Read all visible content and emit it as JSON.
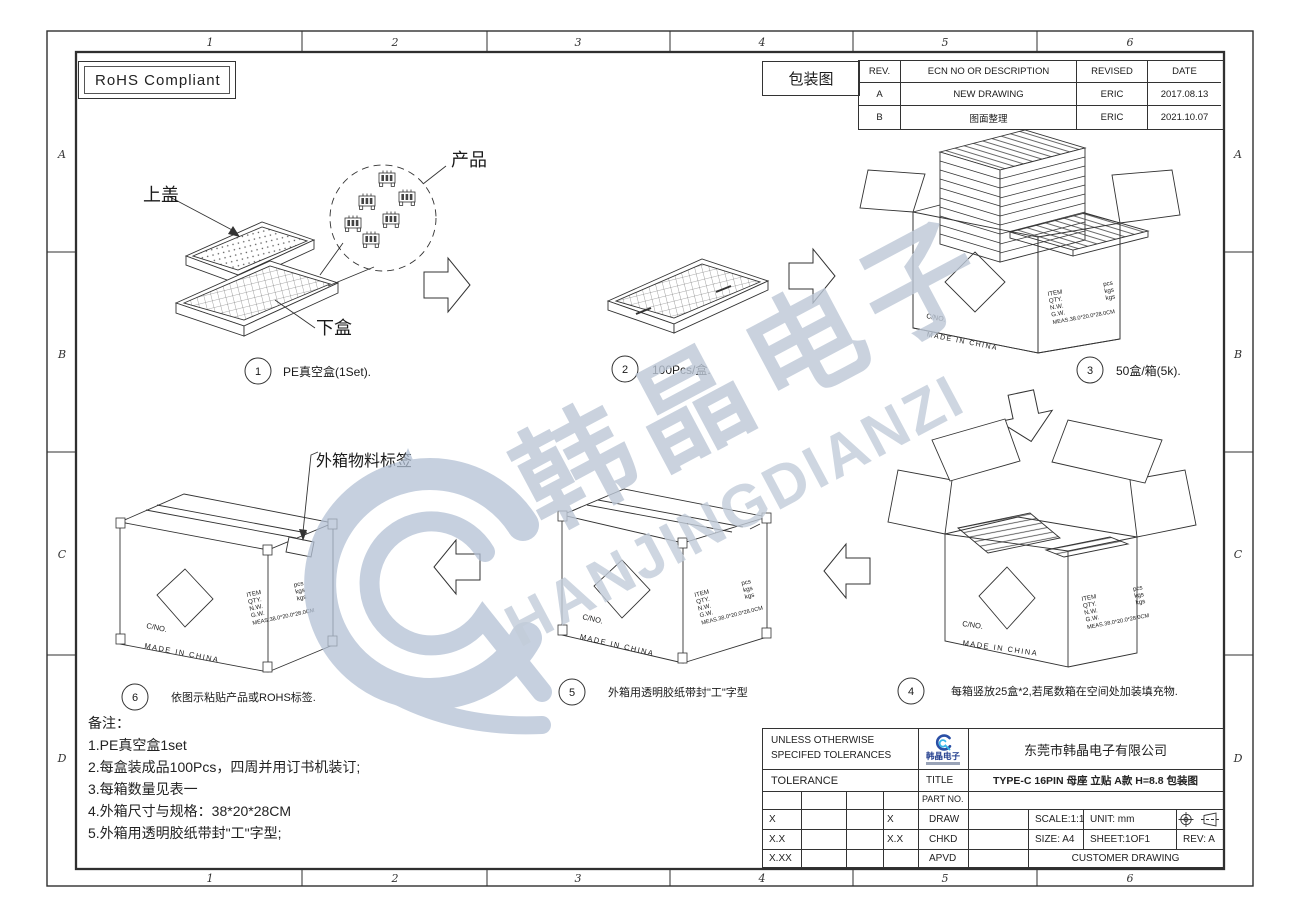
{
  "frame": {
    "cols": [
      "1",
      "2",
      "3",
      "4",
      "5",
      "6"
    ],
    "rows": [
      "A",
      "B",
      "C",
      "D"
    ]
  },
  "rohs_label": "RoHS Compliant",
  "package_label": "包装图",
  "revision_table": {
    "headers": {
      "rev": "REV.",
      "desc": "ECN NO OR DESCRIPTION",
      "revised": "REVISED",
      "date": "DATE"
    },
    "rows": [
      {
        "rev": "A",
        "desc": "NEW DRAWING",
        "revised": "ERIC",
        "date": "2017.08.13"
      },
      {
        "rev": "B",
        "desc": "图面整理",
        "revised": "ERIC",
        "date": "2021.10.07"
      }
    ]
  },
  "callouts": {
    "top_cover": "上盖",
    "bottom_box": "下盒",
    "product": "产品",
    "carton_label": "外箱物料标签"
  },
  "steps": [
    {
      "num": "1",
      "label": "PE真空盒(1Set)."
    },
    {
      "num": "2",
      "label": "100Pcs/盒."
    },
    {
      "num": "3",
      "label": "50盒/箱(5k)."
    },
    {
      "num": "4",
      "label": "每箱竖放25盒*2,若尾数箱在空间处加装填充物."
    },
    {
      "num": "5",
      "label": "外箱用透明胶纸带封\"工\"字型"
    },
    {
      "num": "6",
      "label": "依图示粘贴产品或ROHS标签."
    }
  ],
  "box_markings": {
    "cno": "C/NO.",
    "made_in": "MADE  IN  CHINA",
    "rows": [
      {
        "l": "ITEM",
        "v": "pcs"
      },
      {
        "l": "QTY.",
        "v": "kgs"
      },
      {
        "l": "N.W.",
        "v": "kgs"
      },
      {
        "l": "G.W.",
        "v": ""
      }
    ],
    "meas": "MEAS.38.0*20.0*28.0CM"
  },
  "notes": {
    "title": "备注：",
    "items": [
      "1.PE真空盒1set",
      "2.每盒装成品100Pcs，四周并用订书机装订;",
      "3.每箱数量见表一",
      "4.外箱尺寸与规格：38*20*28CM",
      "5.外箱用透明胶纸带封\"工\"字型;"
    ]
  },
  "title_block": {
    "unless1": "UNLESS OTHERWISE",
    "unless2": "SPECIFED TOLERANCES",
    "tolerance": "TOLERANCE",
    "tol": {
      "r1c1": "X",
      "r1c3": "X",
      "r2c1": "X.X",
      "r2c3": "X.X",
      "r3c1": "X.XX"
    },
    "labels": {
      "title": "TITLE",
      "part_no": "PART NO.",
      "draw": "DRAW",
      "chkd": "CHKD",
      "apvd": "APVD"
    },
    "company": "东莞市韩晶电子有限公司",
    "logo_text": "韩晶电子",
    "title_value": "TYPE-C 16PIN 母座 立贴 A款 H=8.8 包装图",
    "scale": "SCALE:1:1",
    "unit": "UNIT:  mm",
    "size": "SIZE:  A4",
    "sheet": "SHEET:1OF1",
    "rev": "REV:  A",
    "customer": "CUSTOMER DRAWING"
  },
  "watermark": {
    "cn": "韩晶电子",
    "en": "HANJINGDIANZI"
  }
}
